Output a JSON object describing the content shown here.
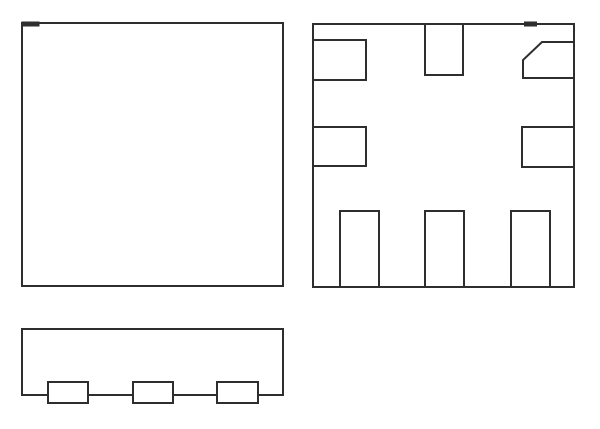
{
  "drawing": {
    "background": "#ffffff",
    "stroke_color": "#2e2e2e",
    "stroke_width": 2,
    "width": 600,
    "height": 429,
    "views": [
      {
        "name": "package-top-view",
        "shapes": [
          {
            "type": "rect",
            "name": "top-view-body-outline",
            "x": 22,
            "y": 23,
            "w": 261,
            "h": 263
          },
          {
            "type": "fillrect",
            "name": "pin1-index-mark-top-view",
            "x": 21.5,
            "y": 21.5,
            "w": 18,
            "h": 5
          }
        ]
      },
      {
        "name": "package-bottom-view",
        "shapes": [
          {
            "type": "rect",
            "name": "bottom-view-body-outline",
            "x": 313,
            "y": 24,
            "w": 261,
            "h": 263
          },
          {
            "type": "polyline",
            "name": "pad-left-top",
            "points": [
              [
                313,
                40
              ],
              [
                366,
                40
              ],
              [
                366,
                80
              ],
              [
                313,
                80
              ]
            ]
          },
          {
            "type": "polyline",
            "name": "pad-left-middle",
            "points": [
              [
                313,
                127
              ],
              [
                366,
                127
              ],
              [
                366,
                166
              ],
              [
                313,
                166
              ]
            ]
          },
          {
            "type": "polyline",
            "name": "pad-top-center",
            "points": [
              [
                425,
                24
              ],
              [
                425,
                75
              ],
              [
                463,
                75
              ],
              [
                463,
                24
              ]
            ]
          },
          {
            "type": "polyline",
            "name": "pad-top-right-chamfered",
            "points": [
              [
                574,
                42
              ],
              [
                542,
                42
              ],
              [
                523,
                60
              ],
              [
                523,
                78
              ],
              [
                574,
                78
              ]
            ]
          },
          {
            "type": "polyline",
            "name": "pad-right-middle",
            "points": [
              [
                574,
                127
              ],
              [
                522,
                127
              ],
              [
                522,
                167
              ],
              [
                574,
                167
              ]
            ]
          },
          {
            "type": "polyline",
            "name": "pad-bottom-left",
            "points": [
              [
                340,
                287
              ],
              [
                340,
                211
              ],
              [
                379,
                211
              ],
              [
                379,
                287
              ]
            ]
          },
          {
            "type": "polyline",
            "name": "pad-bottom-center",
            "points": [
              [
                425,
                287
              ],
              [
                425,
                211
              ],
              [
                464,
                211
              ],
              [
                464,
                287
              ]
            ]
          },
          {
            "type": "polyline",
            "name": "pad-bottom-right",
            "points": [
              [
                511,
                287
              ],
              [
                511,
                211
              ],
              [
                550,
                211
              ],
              [
                550,
                287
              ]
            ]
          },
          {
            "type": "fillrect",
            "name": "pin1-index-mark-bottom-view",
            "x": 524,
            "y": 21.5,
            "w": 13,
            "h": 5
          }
        ]
      },
      {
        "name": "package-side-view",
        "shapes": [
          {
            "type": "rect",
            "name": "side-view-body-outline",
            "x": 22,
            "y": 329,
            "w": 261,
            "h": 66
          },
          {
            "type": "whiterect",
            "name": "side-view-lead-left",
            "x": 48,
            "y": 382,
            "w": 40,
            "h": 21
          },
          {
            "type": "whiterect",
            "name": "side-view-lead-center",
            "x": 133,
            "y": 382,
            "w": 40,
            "h": 21
          },
          {
            "type": "whiterect",
            "name": "side-view-lead-right",
            "x": 217,
            "y": 382,
            "w": 41,
            "h": 21
          }
        ]
      }
    ]
  }
}
